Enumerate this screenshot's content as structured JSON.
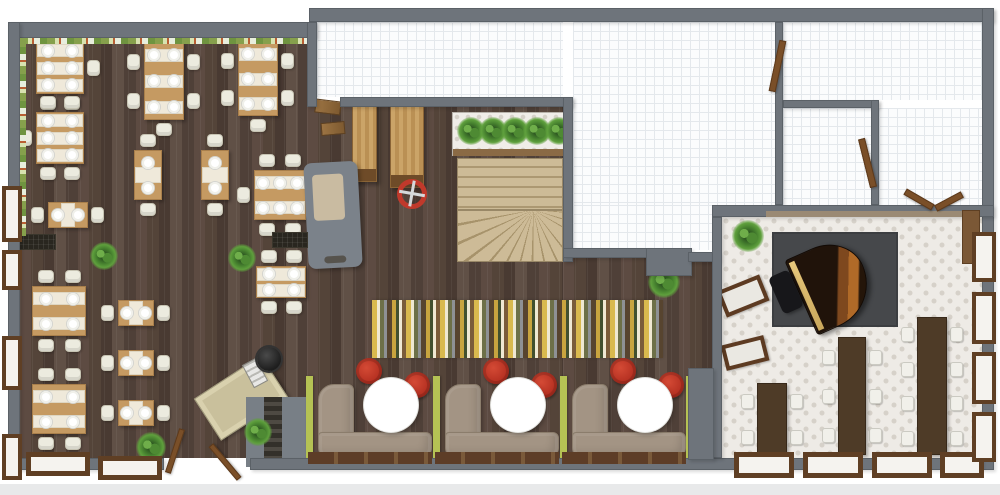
{
  "palette": {
    "wall": "#6e747b",
    "wood_dark": "#52433b",
    "table_wood": "#c59a62",
    "chair_cream": "#ecebdf",
    "accent_red": "#c0392b",
    "lime_green": "#b5c254",
    "sofa_taupe": "#a39484",
    "long_table_brown": "#4e3b27",
    "window_frame": "#5f3f24",
    "rug_dark_gray": "#46484b",
    "stair_tan": "#c3b18e",
    "plant_green": "#47822f"
  },
  "rooms": [
    {
      "name": "main-dining-room",
      "floor": "dark-wood-plank"
    },
    {
      "name": "booth-lounge",
      "floor": "dark-wood-plank"
    },
    {
      "name": "piano-room",
      "floor": "ornamental-tile"
    },
    {
      "name": "top-center-room",
      "floor": "white-grid-tile"
    },
    {
      "name": "top-right-room",
      "floor": "white-grid-tile"
    },
    {
      "name": "right-upper-room",
      "floor": "white-grid-tile"
    },
    {
      "name": "right-lower-room",
      "floor": "white-grid-tile"
    }
  ],
  "counts": {
    "dining_tables": 14,
    "booths": 3,
    "long_tables": 3,
    "windows": 14,
    "doors": 6,
    "plants": 6,
    "grand_piano": 1,
    "winder_staircase": 1
  },
  "furniture": [
    {
      "t": "table",
      "name": "dining-table-6-seat",
      "x": 36,
      "y": 42,
      "w": 48,
      "h": 52,
      "pc": 2,
      "pr": 3,
      "ch": {
        "t": 2,
        "b": 2,
        "r": 1
      }
    },
    {
      "t": "table",
      "name": "dining-table-6-seat",
      "x": 36,
      "y": 112,
      "w": 48,
      "h": 52,
      "pc": 2,
      "pr": 3,
      "ch": {
        "t": 2,
        "b": 2,
        "l": 1
      }
    },
    {
      "t": "table",
      "name": "dining-table-2-seat",
      "x": 48,
      "y": 202,
      "w": 40,
      "h": 26,
      "pc": 2,
      "pr": 1,
      "ch": {
        "l": 1,
        "r": 1
      }
    },
    {
      "t": "table",
      "name": "dining-table-6-seat",
      "x": 144,
      "y": 42,
      "w": 40,
      "h": 78,
      "pc": 2,
      "pr": 3,
      "ch": {
        "t": 1,
        "b": 1,
        "l": 2,
        "r": 2
      }
    },
    {
      "t": "table",
      "name": "dining-table-6-seat",
      "x": 238,
      "y": 42,
      "w": 40,
      "h": 74,
      "pc": 2,
      "pr": 3,
      "ch": {
        "t": 1,
        "b": 1,
        "l": 2,
        "r": 2
      }
    },
    {
      "t": "table",
      "name": "dining-table-2-seat",
      "x": 134,
      "y": 150,
      "w": 28,
      "h": 50,
      "pc": 1,
      "pr": 2,
      "ch": {
        "t": 1,
        "b": 1
      }
    },
    {
      "t": "table",
      "name": "dining-table-2-seat",
      "x": 201,
      "y": 150,
      "w": 28,
      "h": 50,
      "pc": 1,
      "pr": 2,
      "ch": {
        "t": 1,
        "b": 1
      }
    },
    {
      "t": "table",
      "name": "dining-table-6-seat",
      "x": 254,
      "y": 170,
      "w": 52,
      "h": 50,
      "pc": 3,
      "pr": 2,
      "ch": {
        "t": 2,
        "b": 2,
        "l": 1,
        "r": 1
      }
    },
    {
      "t": "table",
      "name": "dining-table-4-seat",
      "x": 32,
      "y": 286,
      "w": 54,
      "h": 50,
      "pc": 2,
      "pr": 2,
      "ch": {
        "t": 2,
        "b": 2
      }
    },
    {
      "t": "table",
      "name": "dining-table-4-seat",
      "x": 32,
      "y": 384,
      "w": 54,
      "h": 50,
      "pc": 2,
      "pr": 2,
      "ch": {
        "t": 2,
        "b": 2
      }
    },
    {
      "t": "table",
      "name": "dining-table-2-seat",
      "x": 118,
      "y": 300,
      "w": 36,
      "h": 26,
      "pc": 2,
      "pr": 1,
      "ch": {
        "l": 1,
        "r": 1
      }
    },
    {
      "t": "table",
      "name": "dining-table-2-seat",
      "x": 118,
      "y": 350,
      "w": 36,
      "h": 26,
      "pc": 2,
      "pr": 1,
      "ch": {
        "l": 1,
        "r": 1
      }
    },
    {
      "t": "table",
      "name": "dining-table-2-seat",
      "x": 118,
      "y": 400,
      "w": 36,
      "h": 26,
      "pc": 2,
      "pr": 1,
      "ch": {
        "l": 1,
        "r": 1
      }
    },
    {
      "t": "table",
      "name": "dining-table-4-seat",
      "x": 256,
      "y": 266,
      "w": 50,
      "h": 32,
      "pc": 2,
      "pr": 2,
      "ch": {
        "t": 2,
        "b": 2
      }
    },
    {
      "t": "booth",
      "name": "booth-unit",
      "x": 312
    },
    {
      "t": "booth",
      "name": "booth-unit",
      "x": 439
    },
    {
      "t": "booth",
      "name": "booth-unit",
      "x": 566
    },
    {
      "t": "rect",
      "cls": "green-panel",
      "name": "booth-divider-panel",
      "x": 306,
      "y": 376,
      "w": 7,
      "h": 84
    },
    {
      "t": "rect",
      "cls": "green-panel",
      "name": "booth-divider-panel",
      "x": 433,
      "y": 376,
      "w": 7,
      "h": 84
    },
    {
      "t": "rect",
      "cls": "green-panel",
      "name": "booth-divider-panel",
      "x": 560,
      "y": 376,
      "w": 7,
      "h": 84
    },
    {
      "t": "rect",
      "cls": "green-panel",
      "name": "booth-divider-panel",
      "x": 686,
      "y": 376,
      "w": 7,
      "h": 84
    },
    {
      "t": "rect",
      "cls": "sill",
      "name": "booth-window-sill",
      "x": 308,
      "y": 452,
      "w": 124,
      "h": 12
    },
    {
      "t": "rect",
      "cls": "sill",
      "name": "booth-window-sill",
      "x": 435,
      "y": 452,
      "w": 124,
      "h": 12
    },
    {
      "t": "rect",
      "cls": "sill",
      "name": "booth-window-sill",
      "x": 562,
      "y": 452,
      "w": 124,
      "h": 12
    },
    {
      "t": "longtable",
      "name": "banquet-table",
      "x": 757,
      "y": 383,
      "w": 30,
      "h": 72,
      "seats": 2
    },
    {
      "t": "longtable",
      "name": "banquet-table",
      "x": 838,
      "y": 337,
      "w": 28,
      "h": 118,
      "seats": 3
    },
    {
      "t": "longtable",
      "name": "banquet-table",
      "x": 917,
      "y": 317,
      "w": 30,
      "h": 138,
      "seats": 4
    },
    {
      "t": "rect",
      "cls": "rug-stripes",
      "name": "striped-area-rug",
      "x": 372,
      "y": 300,
      "w": 291,
      "h": 58
    },
    {
      "t": "rect",
      "cls": "rug-dark",
      "name": "piano-rug",
      "x": 772,
      "y": 232,
      "w": 126,
      "h": 95
    },
    {
      "t": "rect",
      "cls": "piano-body",
      "name": "grand-piano",
      "x": 798,
      "y": 243,
      "w": 70,
      "h": 82,
      "rot": -24
    },
    {
      "t": "rect",
      "cls": "piano-bench",
      "name": "piano-bench",
      "x": 775,
      "y": 272,
      "w": 22,
      "h": 40,
      "rot": -24
    },
    {
      "t": "rect",
      "cls": "wall-bench",
      "name": "bench",
      "x": 720,
      "y": 282,
      "w": 46,
      "h": 28,
      "rot": -22
    },
    {
      "t": "rect",
      "cls": "wall-bench",
      "name": "bench",
      "x": 723,
      "y": 340,
      "w": 44,
      "h": 26,
      "rot": -14
    },
    {
      "t": "rect",
      "cls": "wood-tall",
      "name": "wood-cabinet",
      "x": 962,
      "y": 210,
      "w": 18,
      "h": 54
    },
    {
      "t": "rect",
      "cls": "bar-counter",
      "name": "bar-counter",
      "x": 352,
      "y": 102,
      "w": 25,
      "h": 80
    },
    {
      "t": "rect",
      "cls": "bar-counter",
      "name": "bar-counter",
      "x": 390,
      "y": 104,
      "w": 34,
      "h": 84
    },
    {
      "t": "rect",
      "cls": "wood-shelf",
      "name": "wood-shelf",
      "x": 315,
      "y": 100,
      "w": 26,
      "h": 14,
      "rot": 7
    },
    {
      "t": "rect",
      "cls": "wood-shelf",
      "name": "wood-shelf",
      "x": 321,
      "y": 122,
      "w": 24,
      "h": 13,
      "rot": -5
    },
    {
      "t": "rect",
      "cls": "gray-counter",
      "name": "service-counter",
      "x": 306,
      "y": 162,
      "w": 54,
      "h": 106,
      "rot": -3
    },
    {
      "t": "planter",
      "name": "planter-box",
      "x": 452,
      "y": 112,
      "w": 116,
      "h": 44
    },
    {
      "t": "rect",
      "cls": "stair-top",
      "name": "staircase-upper-flight",
      "x": 457,
      "y": 158,
      "w": 106,
      "h": 52
    },
    {
      "t": "rect",
      "cls": "stair-fan",
      "name": "staircase-winder",
      "x": 457,
      "y": 210,
      "w": 106,
      "h": 52
    },
    {
      "t": "circle",
      "cls": "fan",
      "name": "ceiling-fan",
      "x": 397,
      "y": 179,
      "s": 30
    },
    {
      "t": "rect",
      "cls": "host-desk",
      "name": "host-desk",
      "x": 201,
      "y": 373,
      "w": 80,
      "h": 50,
      "rot": -33
    },
    {
      "t": "rect",
      "cls": "register",
      "name": "cash-register",
      "x": 247,
      "y": 360,
      "w": 16,
      "h": 26,
      "rot": -28
    },
    {
      "t": "circle",
      "cls": "stool",
      "name": "stool",
      "x": 257,
      "y": 347,
      "s": 24
    },
    {
      "t": "rect",
      "cls": "gray-block",
      "name": "entry-platform",
      "x": 246,
      "y": 397,
      "w": 62,
      "h": 70
    },
    {
      "t": "rect",
      "cls": "dark-steps",
      "name": "basement-steps",
      "x": 264,
      "y": 397,
      "w": 18,
      "h": 70
    },
    {
      "t": "plant",
      "name": "potted-plant",
      "x": 90,
      "y": 242,
      "s": 28
    },
    {
      "t": "plant",
      "name": "potted-plant",
      "x": 228,
      "y": 244,
      "s": 28
    },
    {
      "t": "plant",
      "name": "potted-plant",
      "x": 136,
      "y": 432,
      "s": 30
    },
    {
      "t": "plant",
      "name": "potted-plant",
      "x": 244,
      "y": 418,
      "s": 28
    },
    {
      "t": "plant",
      "name": "potted-plant",
      "x": 648,
      "y": 266,
      "s": 32
    },
    {
      "t": "plant",
      "name": "potted-plant",
      "x": 732,
      "y": 220,
      "s": 32
    },
    {
      "t": "mat",
      "name": "floor-mat",
      "x": 18,
      "y": 234,
      "w": 38,
      "h": 16
    },
    {
      "t": "mat",
      "name": "floor-mat",
      "x": 272,
      "y": 232,
      "w": 36,
      "h": 16
    },
    {
      "t": "window",
      "name": "window",
      "x": 2,
      "y": 186,
      "w": 20,
      "h": 56,
      "thin": true
    },
    {
      "t": "window",
      "name": "window",
      "x": 2,
      "y": 250,
      "w": 20,
      "h": 40,
      "thin": true
    },
    {
      "t": "window",
      "name": "window",
      "x": 2,
      "y": 336,
      "w": 20,
      "h": 54,
      "thin": true
    },
    {
      "t": "window",
      "name": "window",
      "x": 2,
      "y": 434,
      "w": 20,
      "h": 46,
      "thin": true
    },
    {
      "t": "window",
      "name": "window",
      "x": 26,
      "y": 452,
      "w": 64,
      "h": 24
    },
    {
      "t": "window",
      "name": "window",
      "x": 98,
      "y": 456,
      "w": 64,
      "h": 24
    },
    {
      "t": "window",
      "name": "window",
      "x": 734,
      "y": 452,
      "w": 60,
      "h": 26
    },
    {
      "t": "window",
      "name": "window",
      "x": 803,
      "y": 452,
      "w": 60,
      "h": 26
    },
    {
      "t": "window",
      "name": "window",
      "x": 872,
      "y": 452,
      "w": 60,
      "h": 26
    },
    {
      "t": "window",
      "name": "window",
      "x": 940,
      "y": 452,
      "w": 44,
      "h": 26
    },
    {
      "t": "window",
      "name": "window",
      "x": 972,
      "y": 232,
      "w": 24,
      "h": 50,
      "thin": true
    },
    {
      "t": "window",
      "name": "window",
      "x": 972,
      "y": 292,
      "w": 24,
      "h": 52,
      "thin": true
    },
    {
      "t": "window",
      "name": "window",
      "x": 972,
      "y": 352,
      "w": 24,
      "h": 52,
      "thin": true
    },
    {
      "t": "window",
      "name": "window",
      "x": 972,
      "y": 412,
      "w": 24,
      "h": 50,
      "thin": true
    },
    {
      "t": "door",
      "name": "door-leaf",
      "x": 774,
      "y": 40,
      "w": 7,
      "h": 52,
      "rot": 12
    },
    {
      "t": "door",
      "name": "door-leaf",
      "x": 864,
      "y": 138,
      "w": 7,
      "h": 50,
      "rot": -14
    },
    {
      "t": "door",
      "name": "door-leaf",
      "x": 903,
      "y": 196,
      "w": 32,
      "h": 7,
      "rot": 30
    },
    {
      "t": "door",
      "name": "door-leaf",
      "x": 934,
      "y": 198,
      "w": 30,
      "h": 7,
      "rot": -28
    },
    {
      "t": "door",
      "name": "entry-door-leaf",
      "x": 172,
      "y": 428,
      "w": 6,
      "h": 46,
      "rot": 18
    },
    {
      "t": "door",
      "name": "entry-door-leaf",
      "x": 222,
      "y": 440,
      "w": 6,
      "h": 44,
      "rot": -40
    }
  ]
}
